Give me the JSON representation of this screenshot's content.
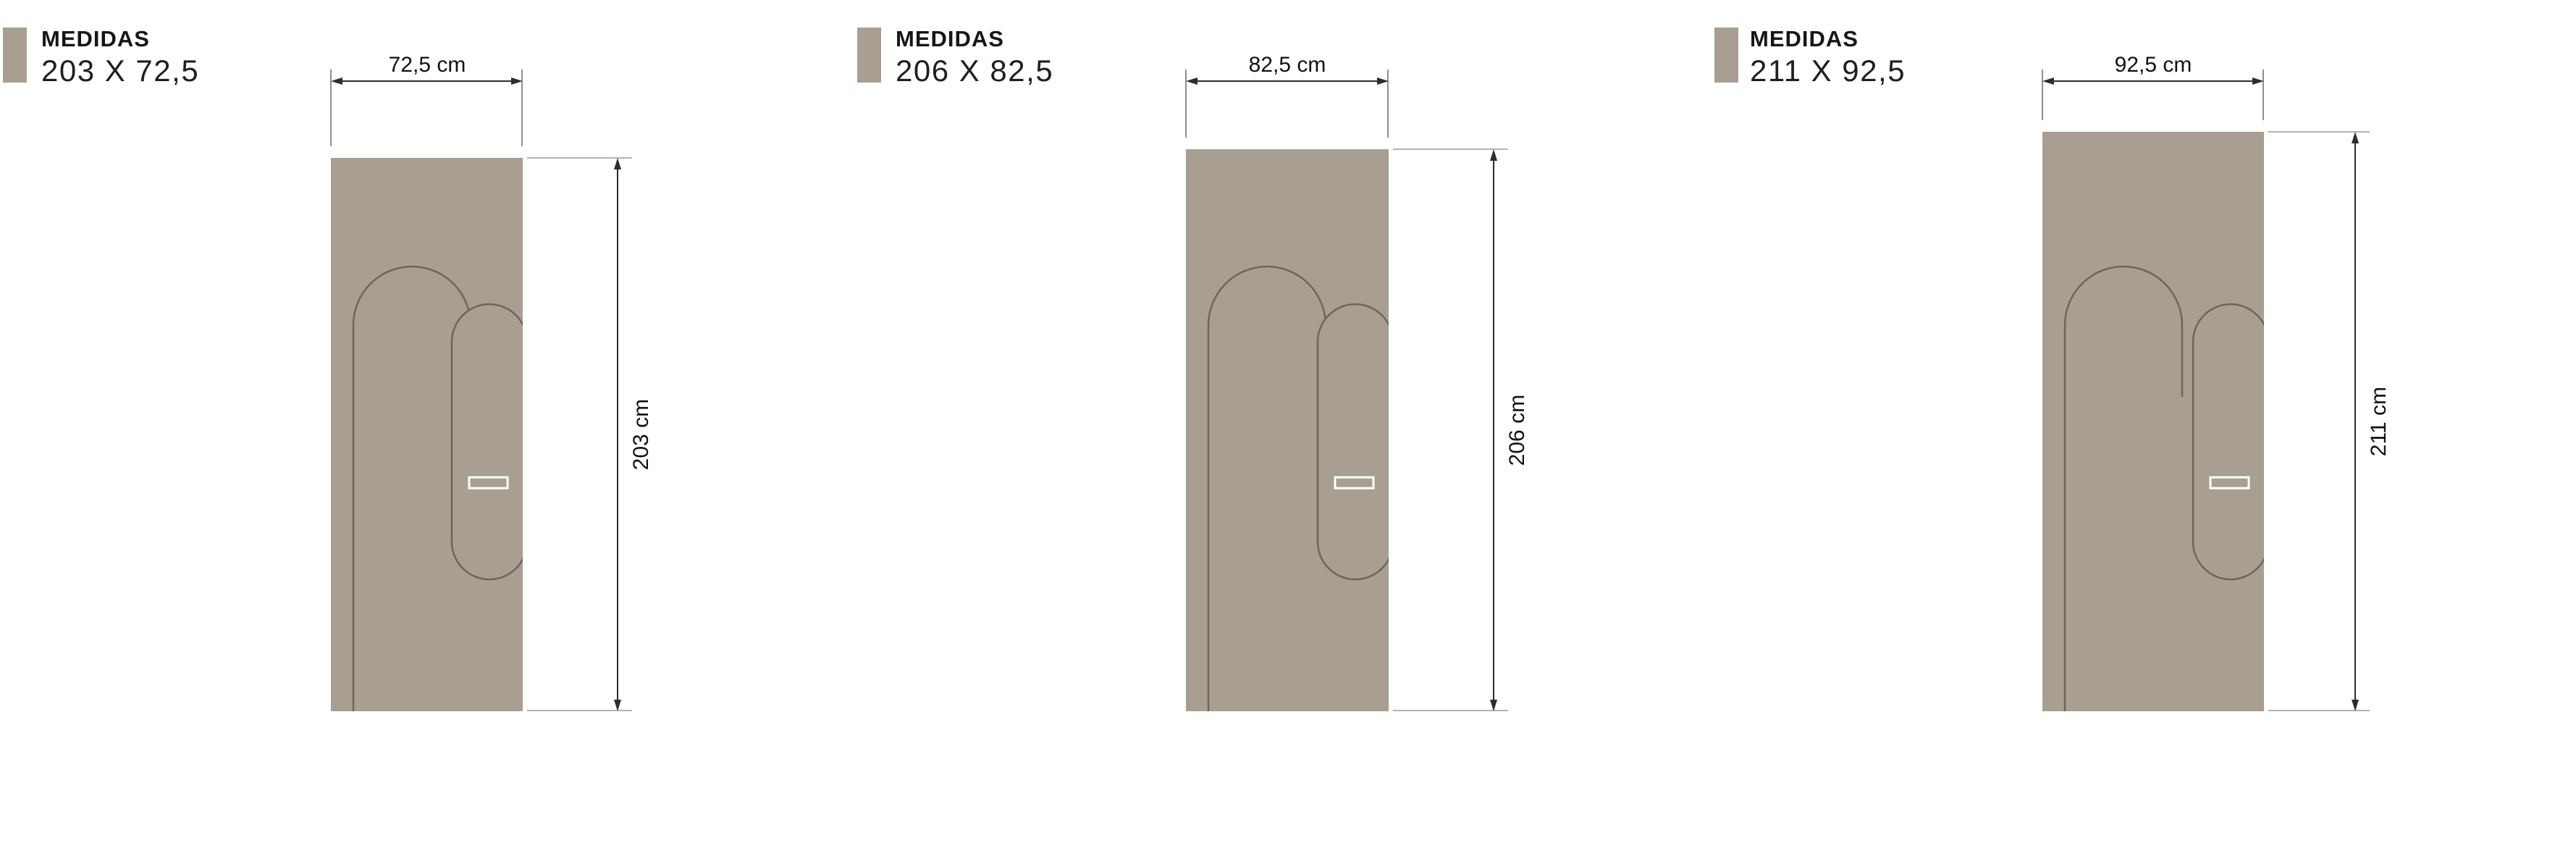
{
  "page": {
    "background": "#ffffff",
    "door_color": "#A89F92",
    "groove_color": "#6E665C",
    "dimension_line_color": "#2d2d2d",
    "extension_line_color": "#8f8f8f",
    "handle_outline_color": "#ffffff"
  },
  "panels": [
    {
      "title": "MEDIDAS",
      "size": "203 X 72,5",
      "width_label": "72,5 cm",
      "height_label": "203 cm"
    },
    {
      "title": "MEDIDAS",
      "size": "206 X 82,5",
      "width_label": "82,5 cm",
      "height_label": "206 cm"
    },
    {
      "title": "MEDIDAS",
      "size": "211 X 92,5",
      "width_label": "92,5 cm",
      "height_label": "211 cm"
    }
  ]
}
